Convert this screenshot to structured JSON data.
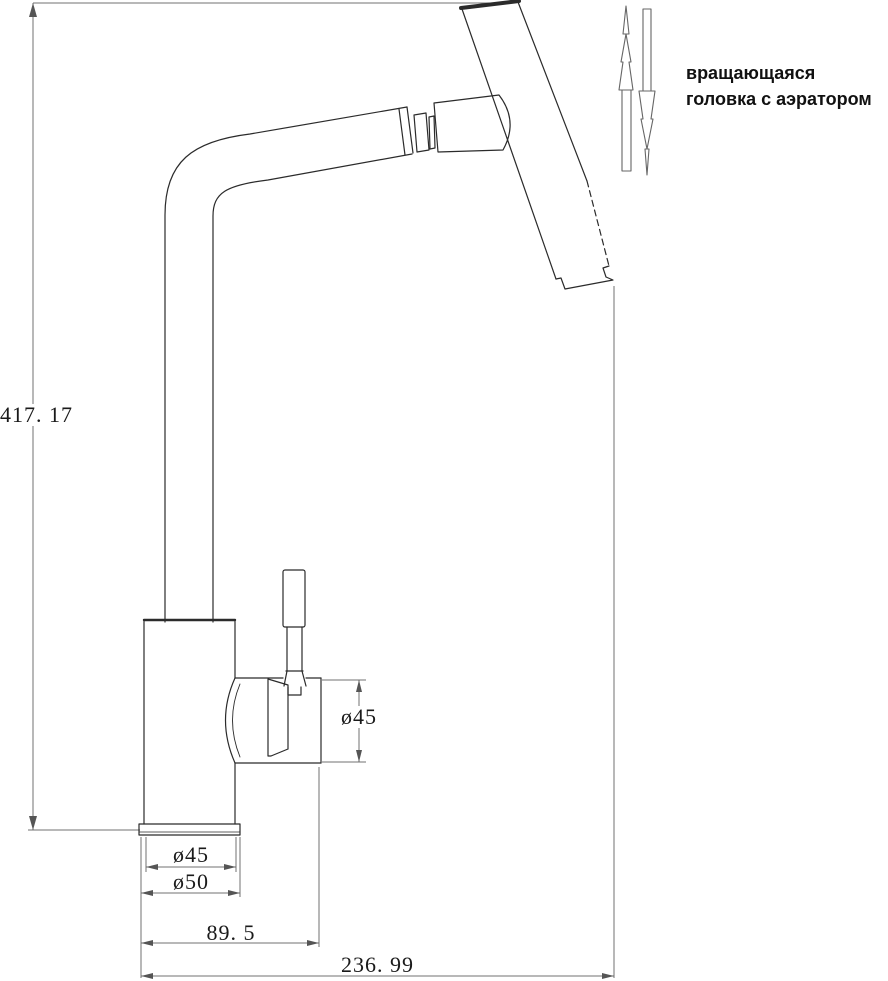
{
  "annotation": {
    "line1": "вращающаяся",
    "line2": "головка с аэратором"
  },
  "dimensions": {
    "overall_height": "417. 17",
    "head_spout_diameter": "ø45",
    "body_diameter": "ø45",
    "base_diameter": "ø50",
    "spout_offset": "89. 5",
    "overall_reach": "236. 99"
  },
  "colors": {
    "outline_line": "#2b2b2b",
    "dimension_line": "#707070",
    "background": "#ffffff",
    "text": "#1a1a1a"
  }
}
